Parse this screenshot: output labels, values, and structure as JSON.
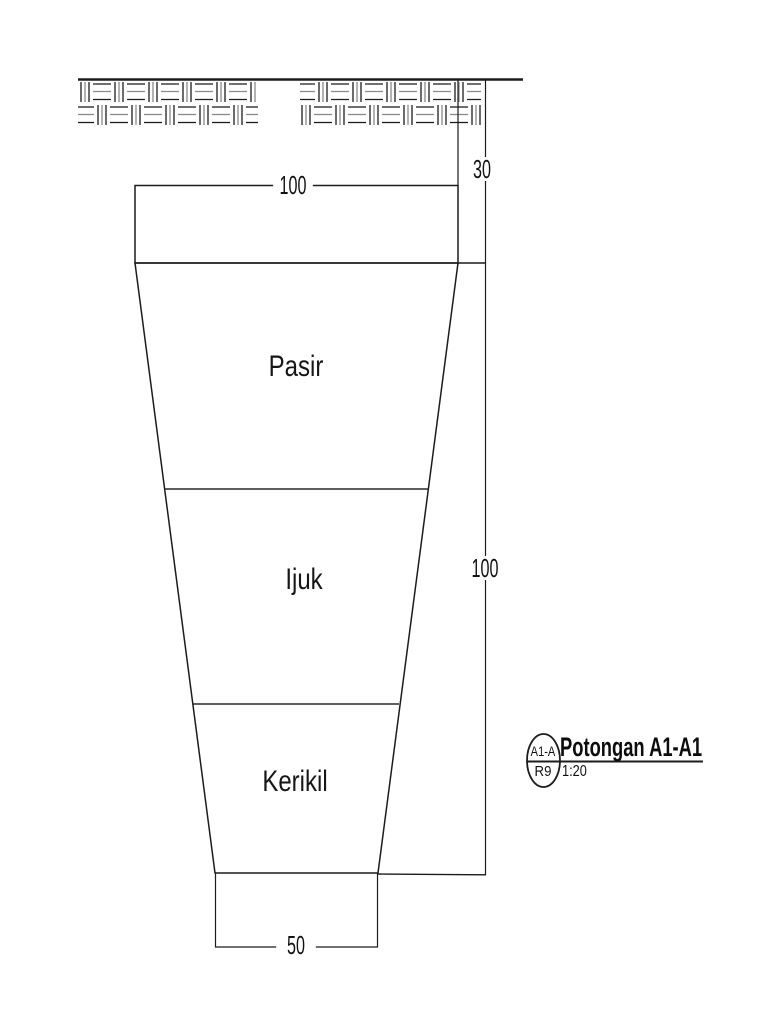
{
  "meta": {
    "background_color": "#ffffff",
    "line_color": "#1c1c1c",
    "hatch_gray_color": "#8a8a8a"
  },
  "drawing": {
    "dimensions": {
      "top_width": "100",
      "cover_depth": "30",
      "body_height": "100",
      "bottom_width": "50"
    },
    "layers": [
      {
        "label": "Pasir"
      },
      {
        "label": "Ijuk"
      },
      {
        "label": "Kerikil"
      }
    ],
    "title_block": {
      "title": "Potongan A1-A1",
      "scale": "1:20",
      "marker_top": "A1-A",
      "marker_bottom": "R9"
    }
  }
}
